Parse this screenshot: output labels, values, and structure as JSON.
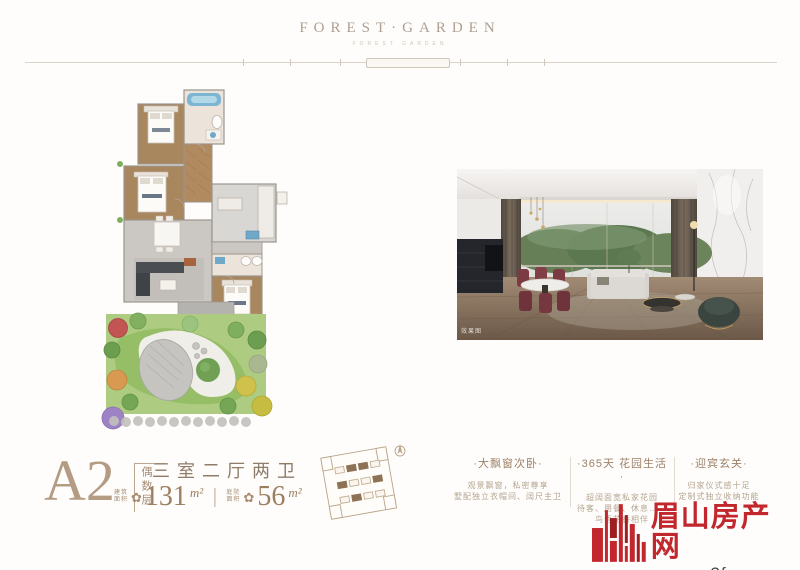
{
  "brand": {
    "title": "FOREST·GARDEN",
    "subtitle": "FOREST GARDEN"
  },
  "photo": {
    "caption": "效果图"
  },
  "unit": {
    "code": "A2",
    "floor_note": "偶数层",
    "layout": "三室二厅两卫",
    "separator": "|",
    "areas": [
      {
        "label_top": "建筑",
        "label_bottom": "面积",
        "icon": "✿",
        "value": "131",
        "unit": "m²"
      },
      {
        "label_top": "庭院",
        "label_bottom": "面积",
        "icon": "✿",
        "value": "56",
        "unit": "m²"
      }
    ]
  },
  "features": [
    {
      "title": "·大飘窗次卧·",
      "lines": [
        "观景飘窗，私密尊享",
        "墅配独立衣帽间、阔尺主卫"
      ]
    },
    {
      "title": "·365天 花园生活·",
      "lines": [
        "超阔面宽私家花园",
        "待客、用餐、休息……",
        "鸟语花香相伴"
      ]
    },
    {
      "title": "·迎宾玄关·",
      "lines": [
        "归家仪式感十足",
        "定制式独立收纳功能"
      ]
    }
  ],
  "watermark": {
    "name": "眉山房产网",
    "url": "www.m3fc.com"
  },
  "colors": {
    "accent_brown": "#a98c6f",
    "logo_red": "#c1272d",
    "floor_wood": "#a8865e",
    "garden_green": "#aecb82"
  }
}
